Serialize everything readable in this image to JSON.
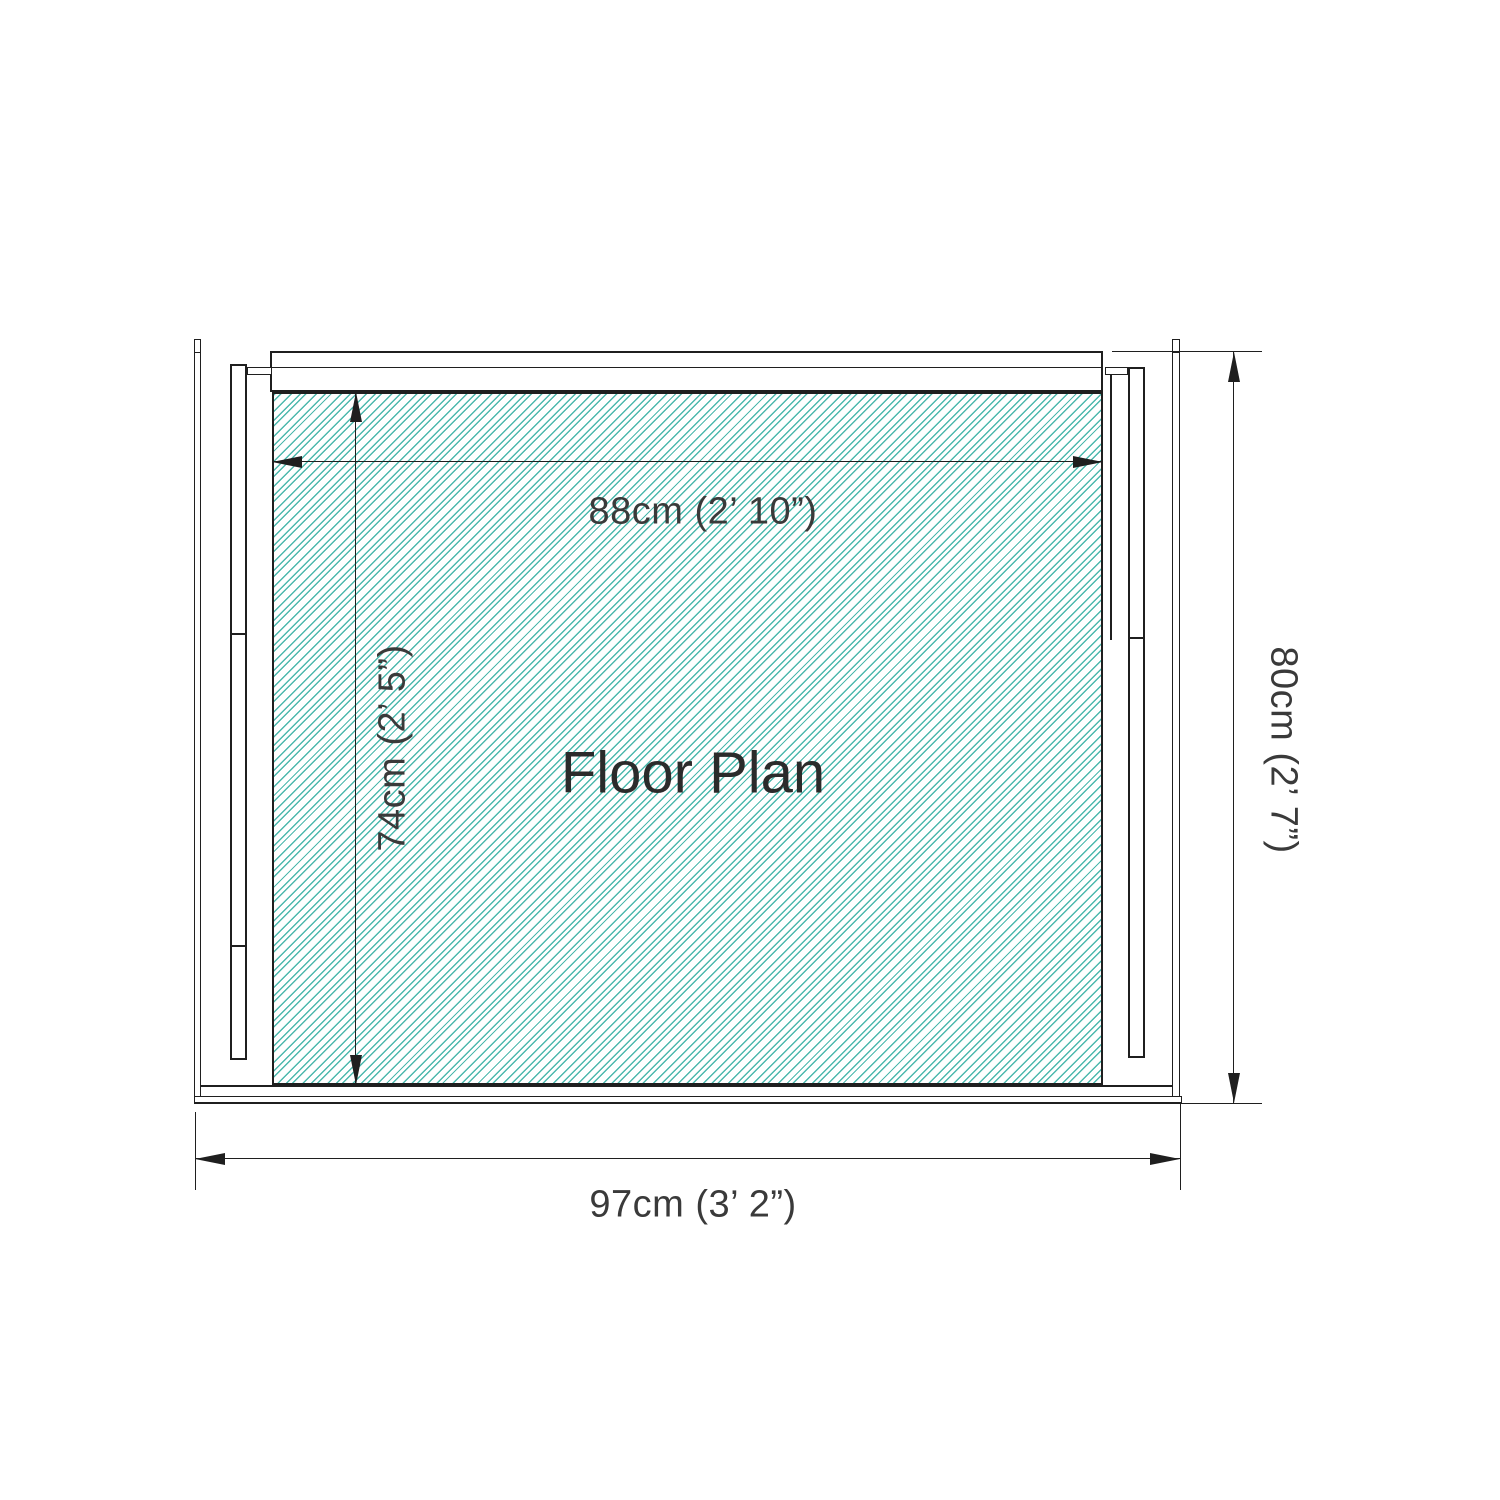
{
  "drawing": {
    "title": "Floor Plan",
    "dimensions": {
      "inner_width": "88cm (2’ 10”)",
      "inner_depth": "74cm (2’ 5”)",
      "outer_width": "97cm (3’ 2”)",
      "outer_depth": "80cm (2’ 7”)"
    },
    "colors": {
      "hatch": "#4cb8ad",
      "line": "#1f1f1f",
      "dim_text": "#3a3a3a",
      "title_text": "#2b2b2b",
      "background": "#ffffff"
    }
  }
}
